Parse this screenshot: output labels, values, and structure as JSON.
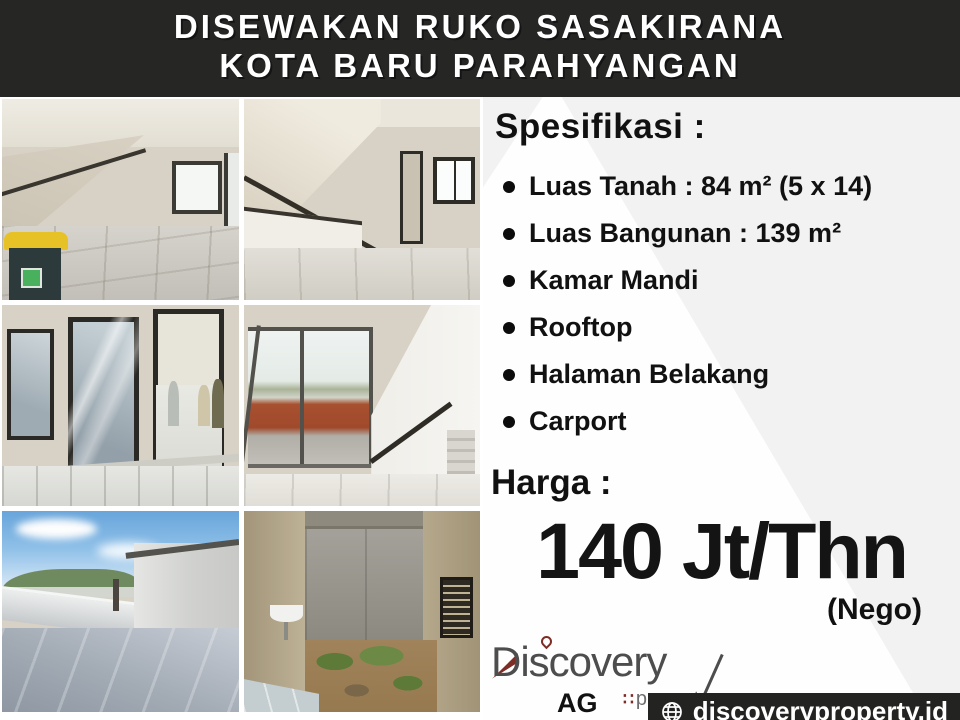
{
  "meta": {
    "width_px": 960,
    "height_px": 720
  },
  "colors": {
    "header_bg": "#262625",
    "header_text": "#ffffff",
    "panel_gray": "#f1f2f1",
    "panel_white": "#fefefe",
    "body_text": "#111111",
    "price_text": "#141414",
    "website_bar_bg": "#232322",
    "logo_gray": "#4d4d4d",
    "logo_accent_red": "#7d2d25",
    "bin_yellow": "#e7c226",
    "fence_red": "#a85030",
    "sky_blue": "#68a5db"
  },
  "header": {
    "line1": "DISEWAKAN RUKO SASAKIRANA",
    "line2": "KOTA BARU PARAHYANGAN"
  },
  "photos": [
    {
      "name": "interior-room-staircase-with-trash-bin"
    },
    {
      "name": "interior-room-staircase-window"
    },
    {
      "name": "glass-facade-with-people-inside"
    },
    {
      "name": "room-glass-doors-terrace-red-fence-staircase"
    },
    {
      "name": "rooftop-terrace-sky-mountains"
    },
    {
      "name": "backyard-courtyard-with-sink"
    }
  ],
  "panel": {
    "spec_heading": "Spesifikasi :",
    "spec_items": [
      "Luas Tanah : 84 m² (5 x 14)",
      "Luas Bangunan : 139 m²",
      "Kamar Mandi",
      "Rooftop",
      "Halaman Belakang",
      "Carport"
    ],
    "harga_label": "Harga :",
    "price": "140 Jt/Thn",
    "nego": "(Nego)",
    "logo": {
      "brand": "Discovery",
      "sub": "property",
      "squares": "∷",
      "agent": "AG"
    },
    "website": "discoveryproperty.id"
  }
}
